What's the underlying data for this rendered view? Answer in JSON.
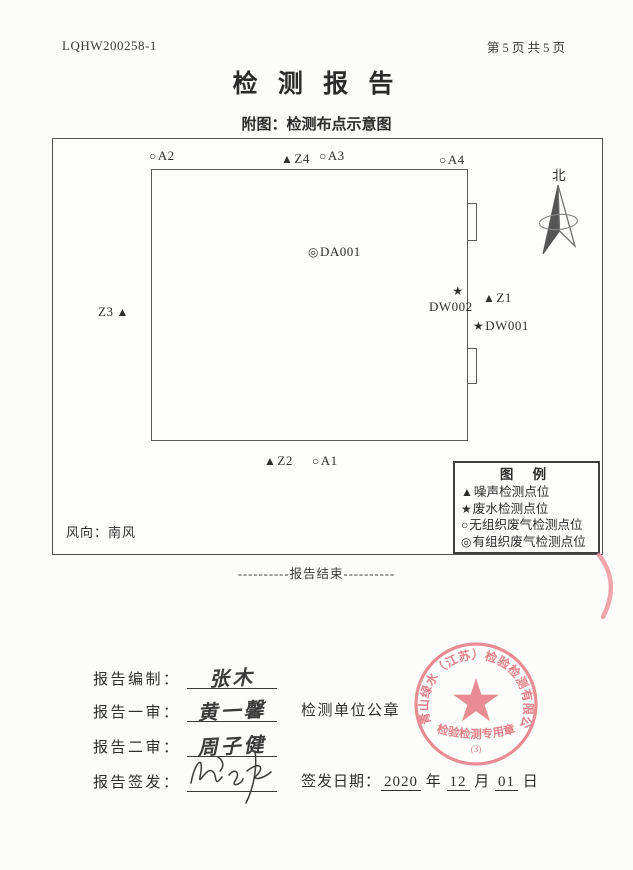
{
  "page": {
    "report_code": "LQHW200258-1",
    "page_info": "第 5 页 共 5 页",
    "title": "检 测 报 告",
    "subtitle": "附图：检测布点示意图",
    "report_end": "----------报告结束----------"
  },
  "diagram": {
    "north_label": "北",
    "wind_text": "风向：南风",
    "markers": [
      {
        "symbol": "○",
        "label": "A2"
      },
      {
        "symbol": "▲",
        "label": "Z4"
      },
      {
        "symbol": "○",
        "label": "A3"
      },
      {
        "symbol": "○",
        "label": "A4"
      },
      {
        "symbol": "◎",
        "label": "DA001"
      },
      {
        "symbol": "★",
        "label": "DW002"
      },
      {
        "symbol": "▲",
        "label": "Z1"
      },
      {
        "symbol": "★",
        "label": "DW001"
      },
      {
        "symbol": "▲",
        "label": "Z3"
      },
      {
        "symbol": "▲",
        "label": "Z2"
      },
      {
        "symbol": "○",
        "label": "A1"
      }
    ],
    "legend": {
      "title": "图  例",
      "items": [
        {
          "symbol": "▲",
          "label": "噪声检测点位"
        },
        {
          "symbol": "★",
          "label": "废水检测点位"
        },
        {
          "symbol": "○",
          "label": "无组织废气检测点位"
        },
        {
          "symbol": "◎",
          "label": "有组织废气检测点位"
        }
      ]
    }
  },
  "signoff": {
    "rows": [
      {
        "label": "报告编制：",
        "name": "张木"
      },
      {
        "label": "报告一审：",
        "name": "黄一馨"
      },
      {
        "label": "报告二审：",
        "name": "周子健"
      },
      {
        "label": "报告签发：",
        "name": ""
      }
    ],
    "seal_caption": "检测单位公章",
    "date_label": "签发日期：",
    "date": {
      "year": "2020",
      "year_unit": "年",
      "month": "12",
      "month_unit": "月",
      "day": "01",
      "day_unit": "日"
    }
  },
  "seal": {
    "company": "青山绿水（江苏）检验检测有限公司",
    "type_text": "检验检测专用章",
    "number": "(3)",
    "color": "#e8808a"
  }
}
